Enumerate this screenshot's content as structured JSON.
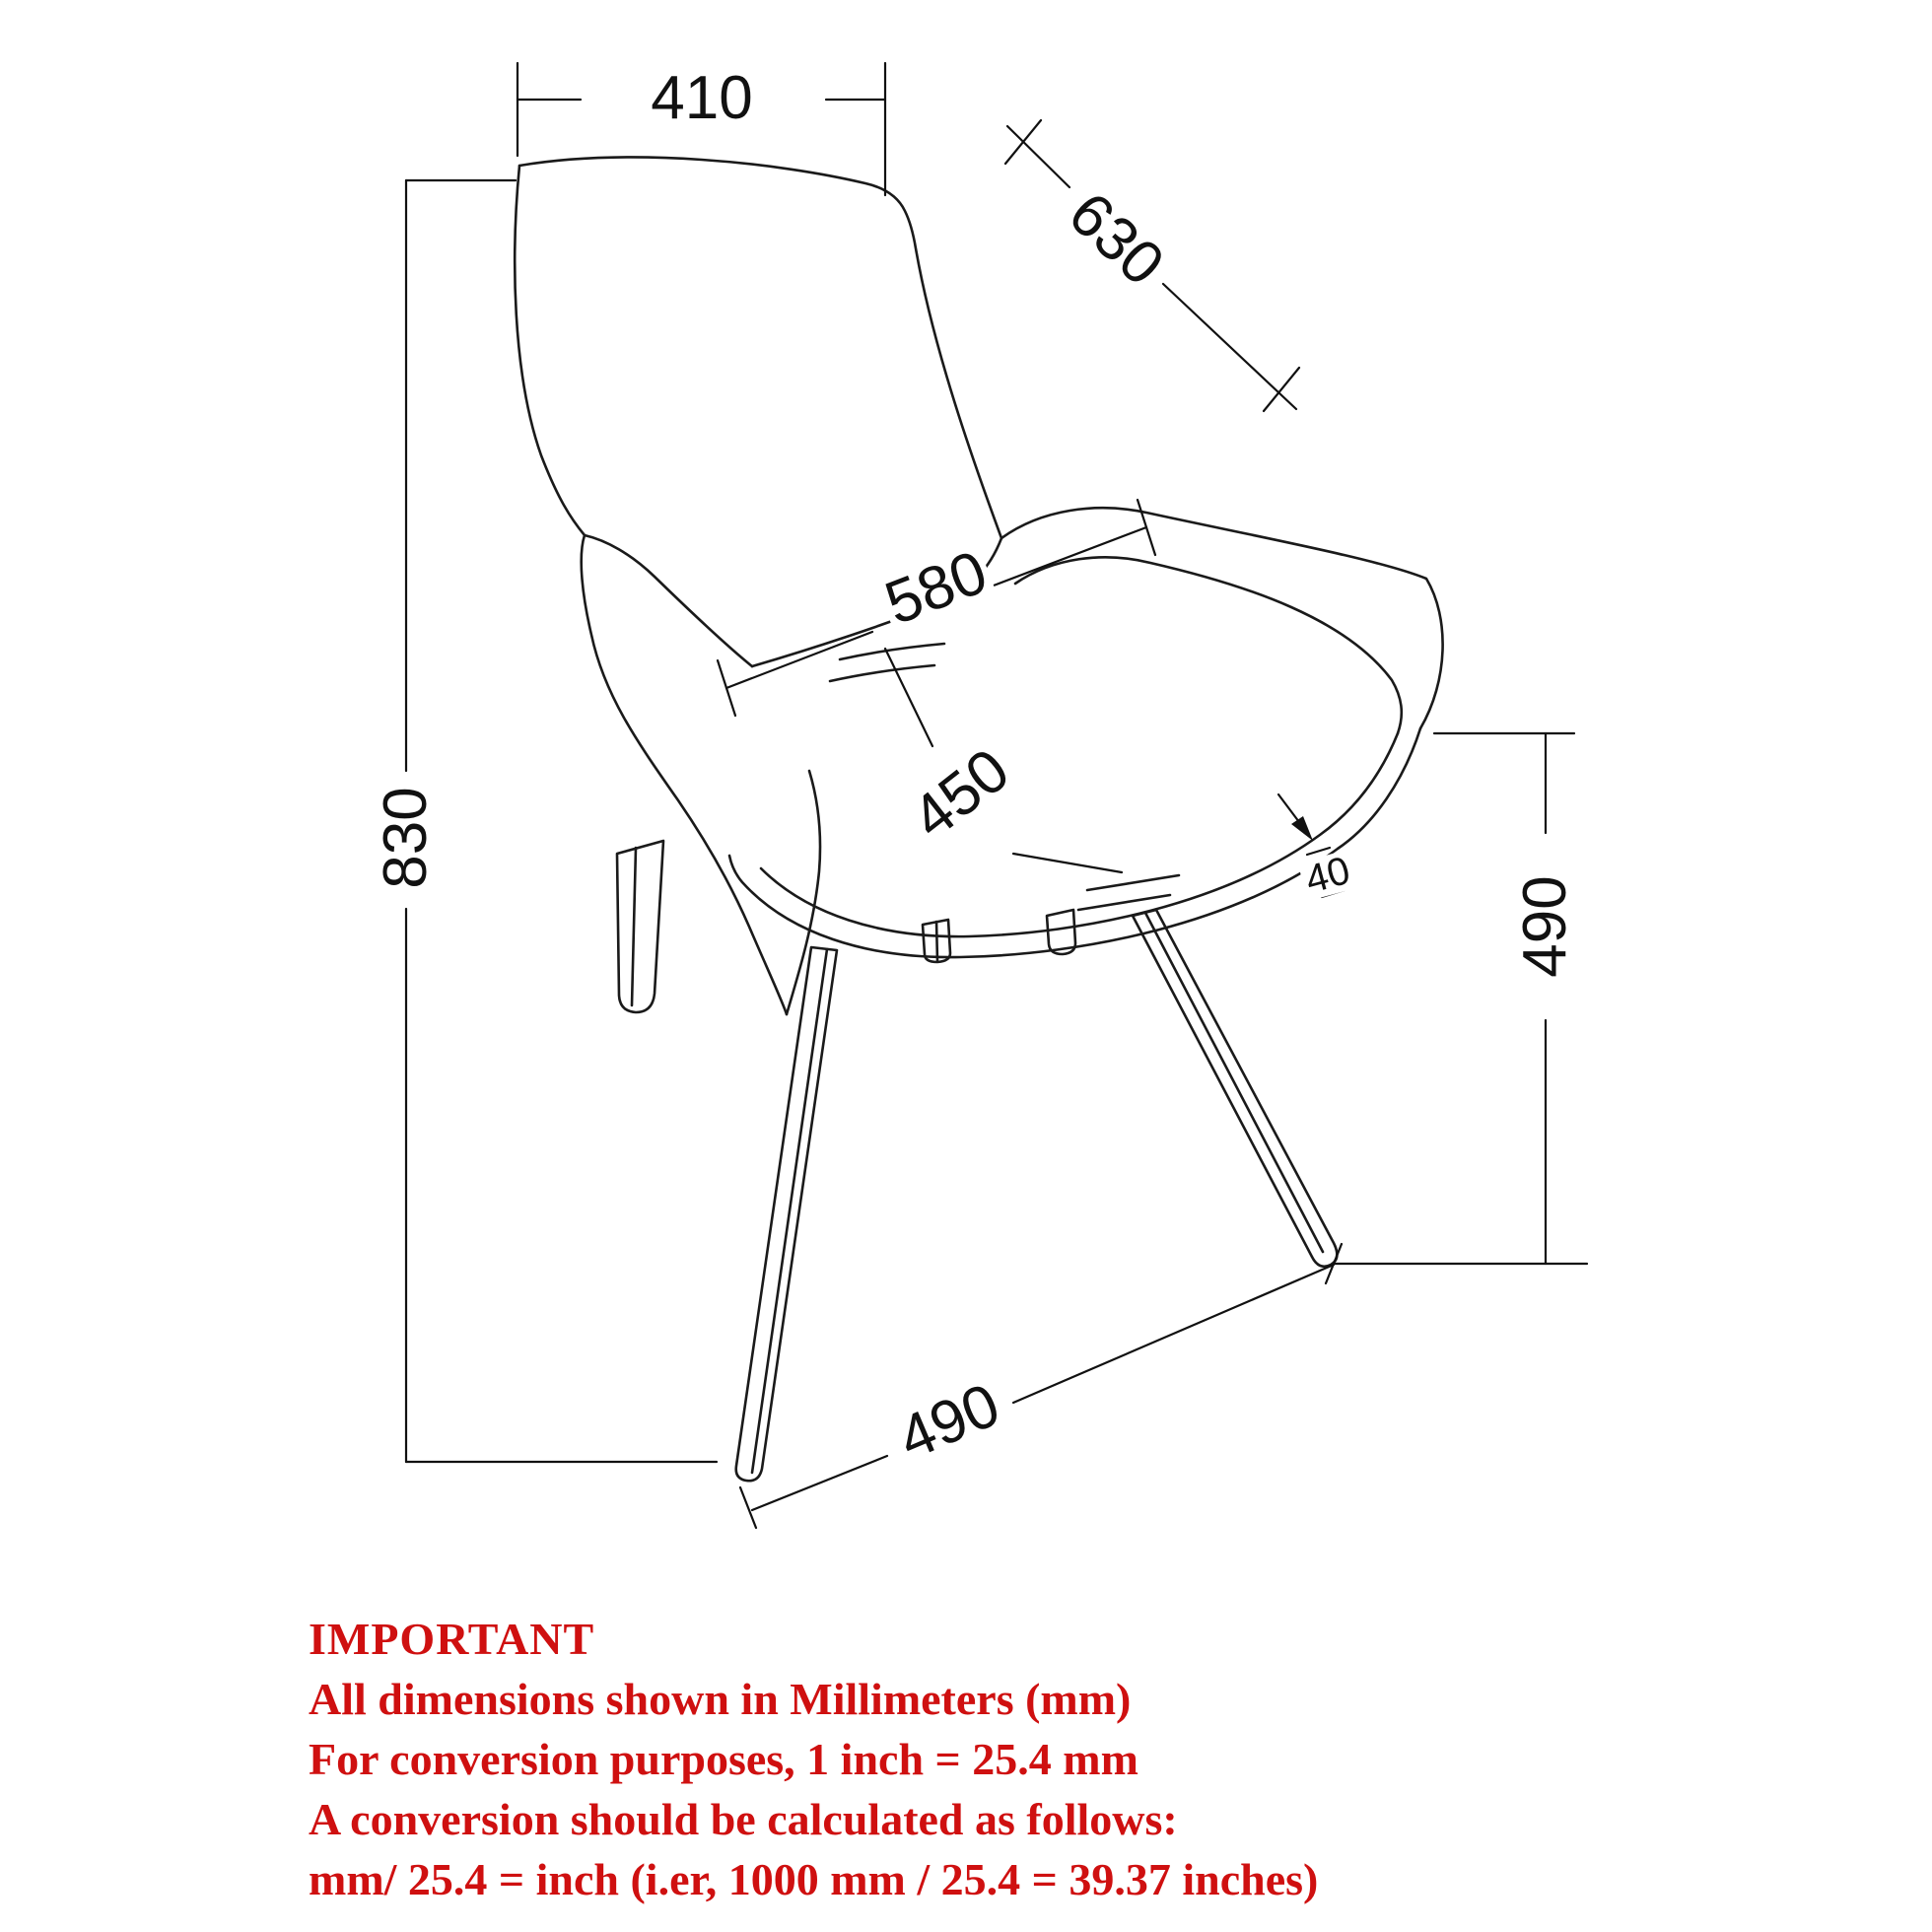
{
  "diagram": {
    "type": "furniture-dimension-drawing",
    "subject": "armchair line drawing, three-quarter view",
    "units": "mm",
    "line_color": "#1a1a1a",
    "note_color": "#cf1010",
    "dimensions": {
      "backrest_top_width": "410",
      "backrest_diagonal_height": "630",
      "seat_width": "580",
      "seat_depth": "450",
      "overall_height": "830",
      "seat_height": "490",
      "seat_thickness": "40",
      "leg_spread_depth": "490"
    }
  },
  "notes": {
    "heading": "IMPORTANT",
    "lines": [
      "All dimensions shown in Millimeters (mm)",
      "For conversion purposes, 1 inch = 25.4 mm",
      "A conversion should be calculated as follows:",
      "mm/ 25.4 = inch (i.er, 1000 mm / 25.4 = 39.37 inches)"
    ]
  }
}
